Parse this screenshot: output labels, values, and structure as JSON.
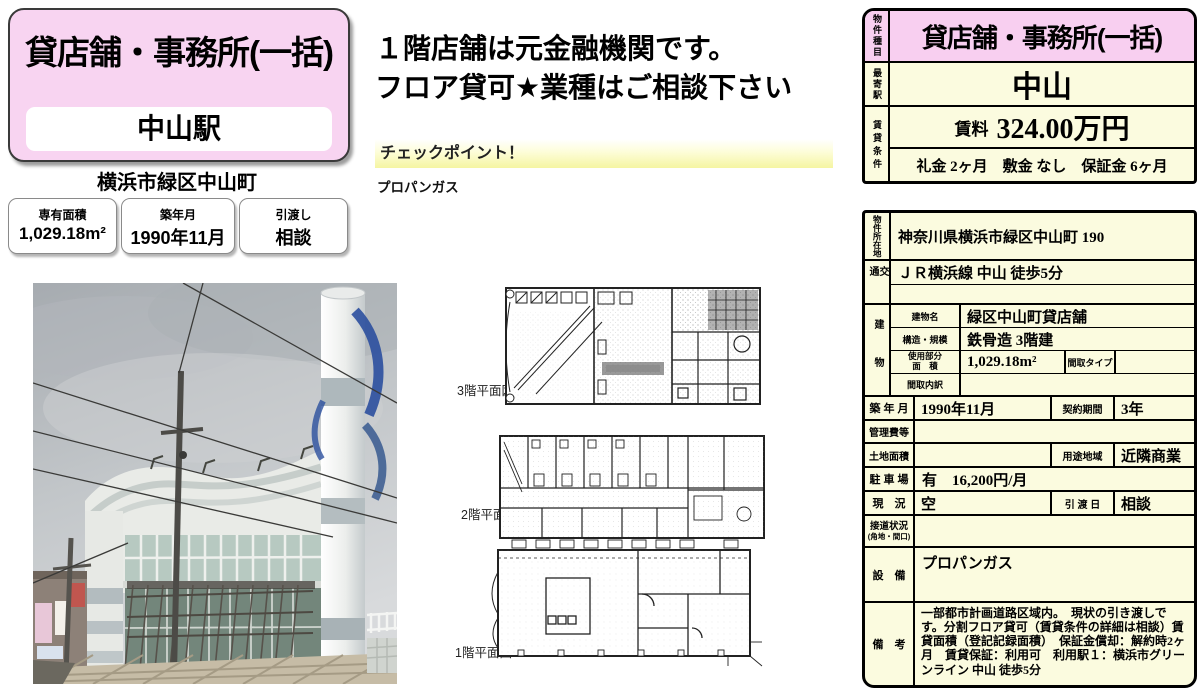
{
  "left": {
    "property_type": "貸店舗・事務所(一括)",
    "station": "中山駅",
    "address": "横浜市緑区中山町",
    "badges": [
      {
        "label": "専有面積",
        "value": "1,029.18m²"
      },
      {
        "label": "築年月",
        "value": "1990年11月"
      },
      {
        "label": "引渡し",
        "value": "相談"
      }
    ]
  },
  "center": {
    "headline1": "１階店舗は元金融機関です。",
    "headline2": "フロア貸可★業種はご相談下さい",
    "checkpoint_title": "チェックポイント！",
    "checkpoint_item": "プロパンガス",
    "floorplan_labels": [
      "3階平面図",
      "2階平面図",
      "1階平面図"
    ]
  },
  "summary": {
    "type_label": "物件種目",
    "type_value": "貸店舗・事務所(一括)",
    "station_label": "最寄駅",
    "station_value": "中山",
    "terms_label": "賃貸条件",
    "rent_label": "賃料",
    "rent_value": "324.00万円",
    "terms_value": "礼金 2ヶ月　敷金 なし　保証金 6ヶ月"
  },
  "details": {
    "location_label": "物件所在地",
    "location": "神奈川県横浜市緑区中山町 190",
    "access_label": "交通",
    "access": "ＪＲ横浜線 中山 徒歩5分",
    "building_label": "建物",
    "building_name_label": "建物名",
    "building_name": "緑区中山町貸店舗",
    "structure_label": "構造・規模",
    "structure": "鉄骨造 3階建",
    "used_area_label1": "使用部分",
    "used_area_label2": "面　積",
    "used_area": "1,029.18m²",
    "madori_type_label": "間取タイプ",
    "madori_detail_label": "間取内訳",
    "built_label": "築 年 月",
    "built": "1990年11月",
    "contract_label": "契約期間",
    "contract": "3年",
    "mgmt_label": "管理費等",
    "land_label": "土地面積",
    "zone_label": "用途地域",
    "zone": "近隣商業",
    "parking_label": "駐 車 場",
    "parking": "有　16,200円/月",
    "status_label": "現　況",
    "status": "空",
    "handover_label": "引 渡 日",
    "handover": "相談",
    "road_label1": "接道状況",
    "road_label2": "(角地・間口)",
    "equip_label": "設　備",
    "equipment": "プロパンガス",
    "notes_label": "備　考",
    "notes": "一部都市計画道路区域内。　現状の引き渡しです。分割フロア貸可（賃貸条件の詳細は相談）賃貸面積（登記記録面積）　保証金償却：解約時2ヶ月　賃貸保証：利用可　利用駅１：横浜市グリーンライン 中山 徒歩5分"
  },
  "colors": {
    "pink": "#f8cff0",
    "cream": "#fbfbdf",
    "checkpoint_yellow": "#f5f5a2"
  }
}
